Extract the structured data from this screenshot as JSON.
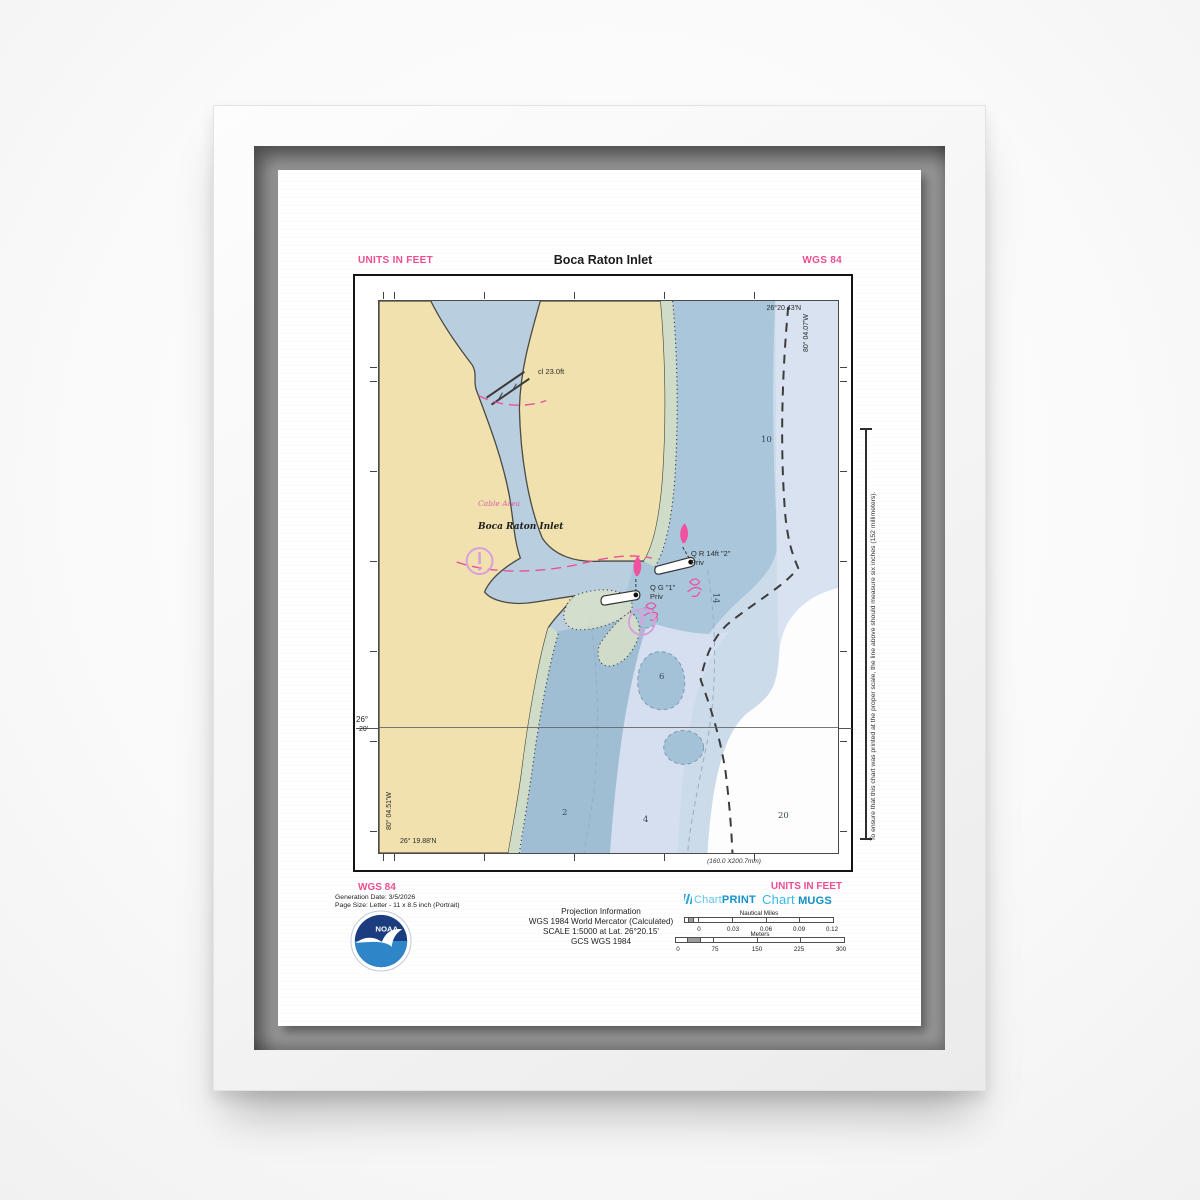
{
  "poster": {
    "header": {
      "units_label": "UNITS IN FEET",
      "title": "Boca Raton Inlet",
      "datum_label": "WGS 84"
    },
    "map": {
      "feature_labels": {
        "bridge_clearance": "cl 23.0ft",
        "cable_area": "Cable Area",
        "inlet_name": "Boca Raton Inlet",
        "red_buoy_line1": "Q R 14ft \"2\"",
        "red_buoy_line2": "Priv",
        "green_buoy_line1": "Q G \"1\"",
        "green_buoy_line2": "Priv"
      },
      "depths_ft": {
        "d10": "10",
        "d14": "14",
        "d6": "6",
        "d2": "2",
        "d4": "4",
        "d20": "20"
      },
      "graticule": {
        "top_right_lat": "26°20.43'N",
        "top_right_lon": "80° 04.07'W",
        "bottom_left_lon": "80° 04.51'W",
        "bottom_left_lat": "26° 19.88'N",
        "lat_label_deg": "26°",
        "lat_label_min": "20'"
      },
      "neatline_dimensions": "(160.0 X200.7mm)",
      "scale_check_note": "To ensure that this chart was printed at the proper scale, the line above should measure six inches (152 millimeters)."
    },
    "footer": {
      "datum_label": "WGS 84",
      "generation_date": "Generation Date: 3/5/2026",
      "page_size": "Page Size: Letter - 11 x 8.5 inch (Portrait)",
      "units_label": "UNITS IN FEET",
      "projection_info": {
        "heading": "Projection Information",
        "line1": "WGS 1984 World Mercator (Calculated)",
        "line2": "SCALE 1:5000 at Lat. 26°20.15'",
        "line3": "GCS WGS 1984"
      },
      "noaa_text": "NOAA",
      "brands": {
        "print_word": "Chart",
        "print_bold": "PRINT",
        "mugs_word": "Chart",
        "mugs_bold": "MUGS"
      },
      "scale_bars": {
        "nautical_miles": {
          "label": "Nautical Miles",
          "ticks": [
            "0",
            "0.03",
            "0.06",
            "0.09",
            "0.12"
          ]
        },
        "meters": {
          "label": "Meters",
          "ticks": [
            "0",
            "75",
            "150",
            "225",
            "300"
          ]
        }
      }
    },
    "colors": {
      "accent_pink": "#ee4d92",
      "land_tan": "#f0e1ae",
      "water_lake": "#b9cfe0",
      "water_base": "#ccdbe9",
      "water_mid": "#a9c6da",
      "water_shallow": "#9fbed4",
      "water_pale": "#d6dff0",
      "foreshore_green": "#cfdcc8",
      "symbol_magenta": "#f052a0",
      "caution_purple": "#d9a0dd",
      "brand_teal_light": "#54c0e8",
      "brand_teal_dark": "#1593cc"
    }
  }
}
